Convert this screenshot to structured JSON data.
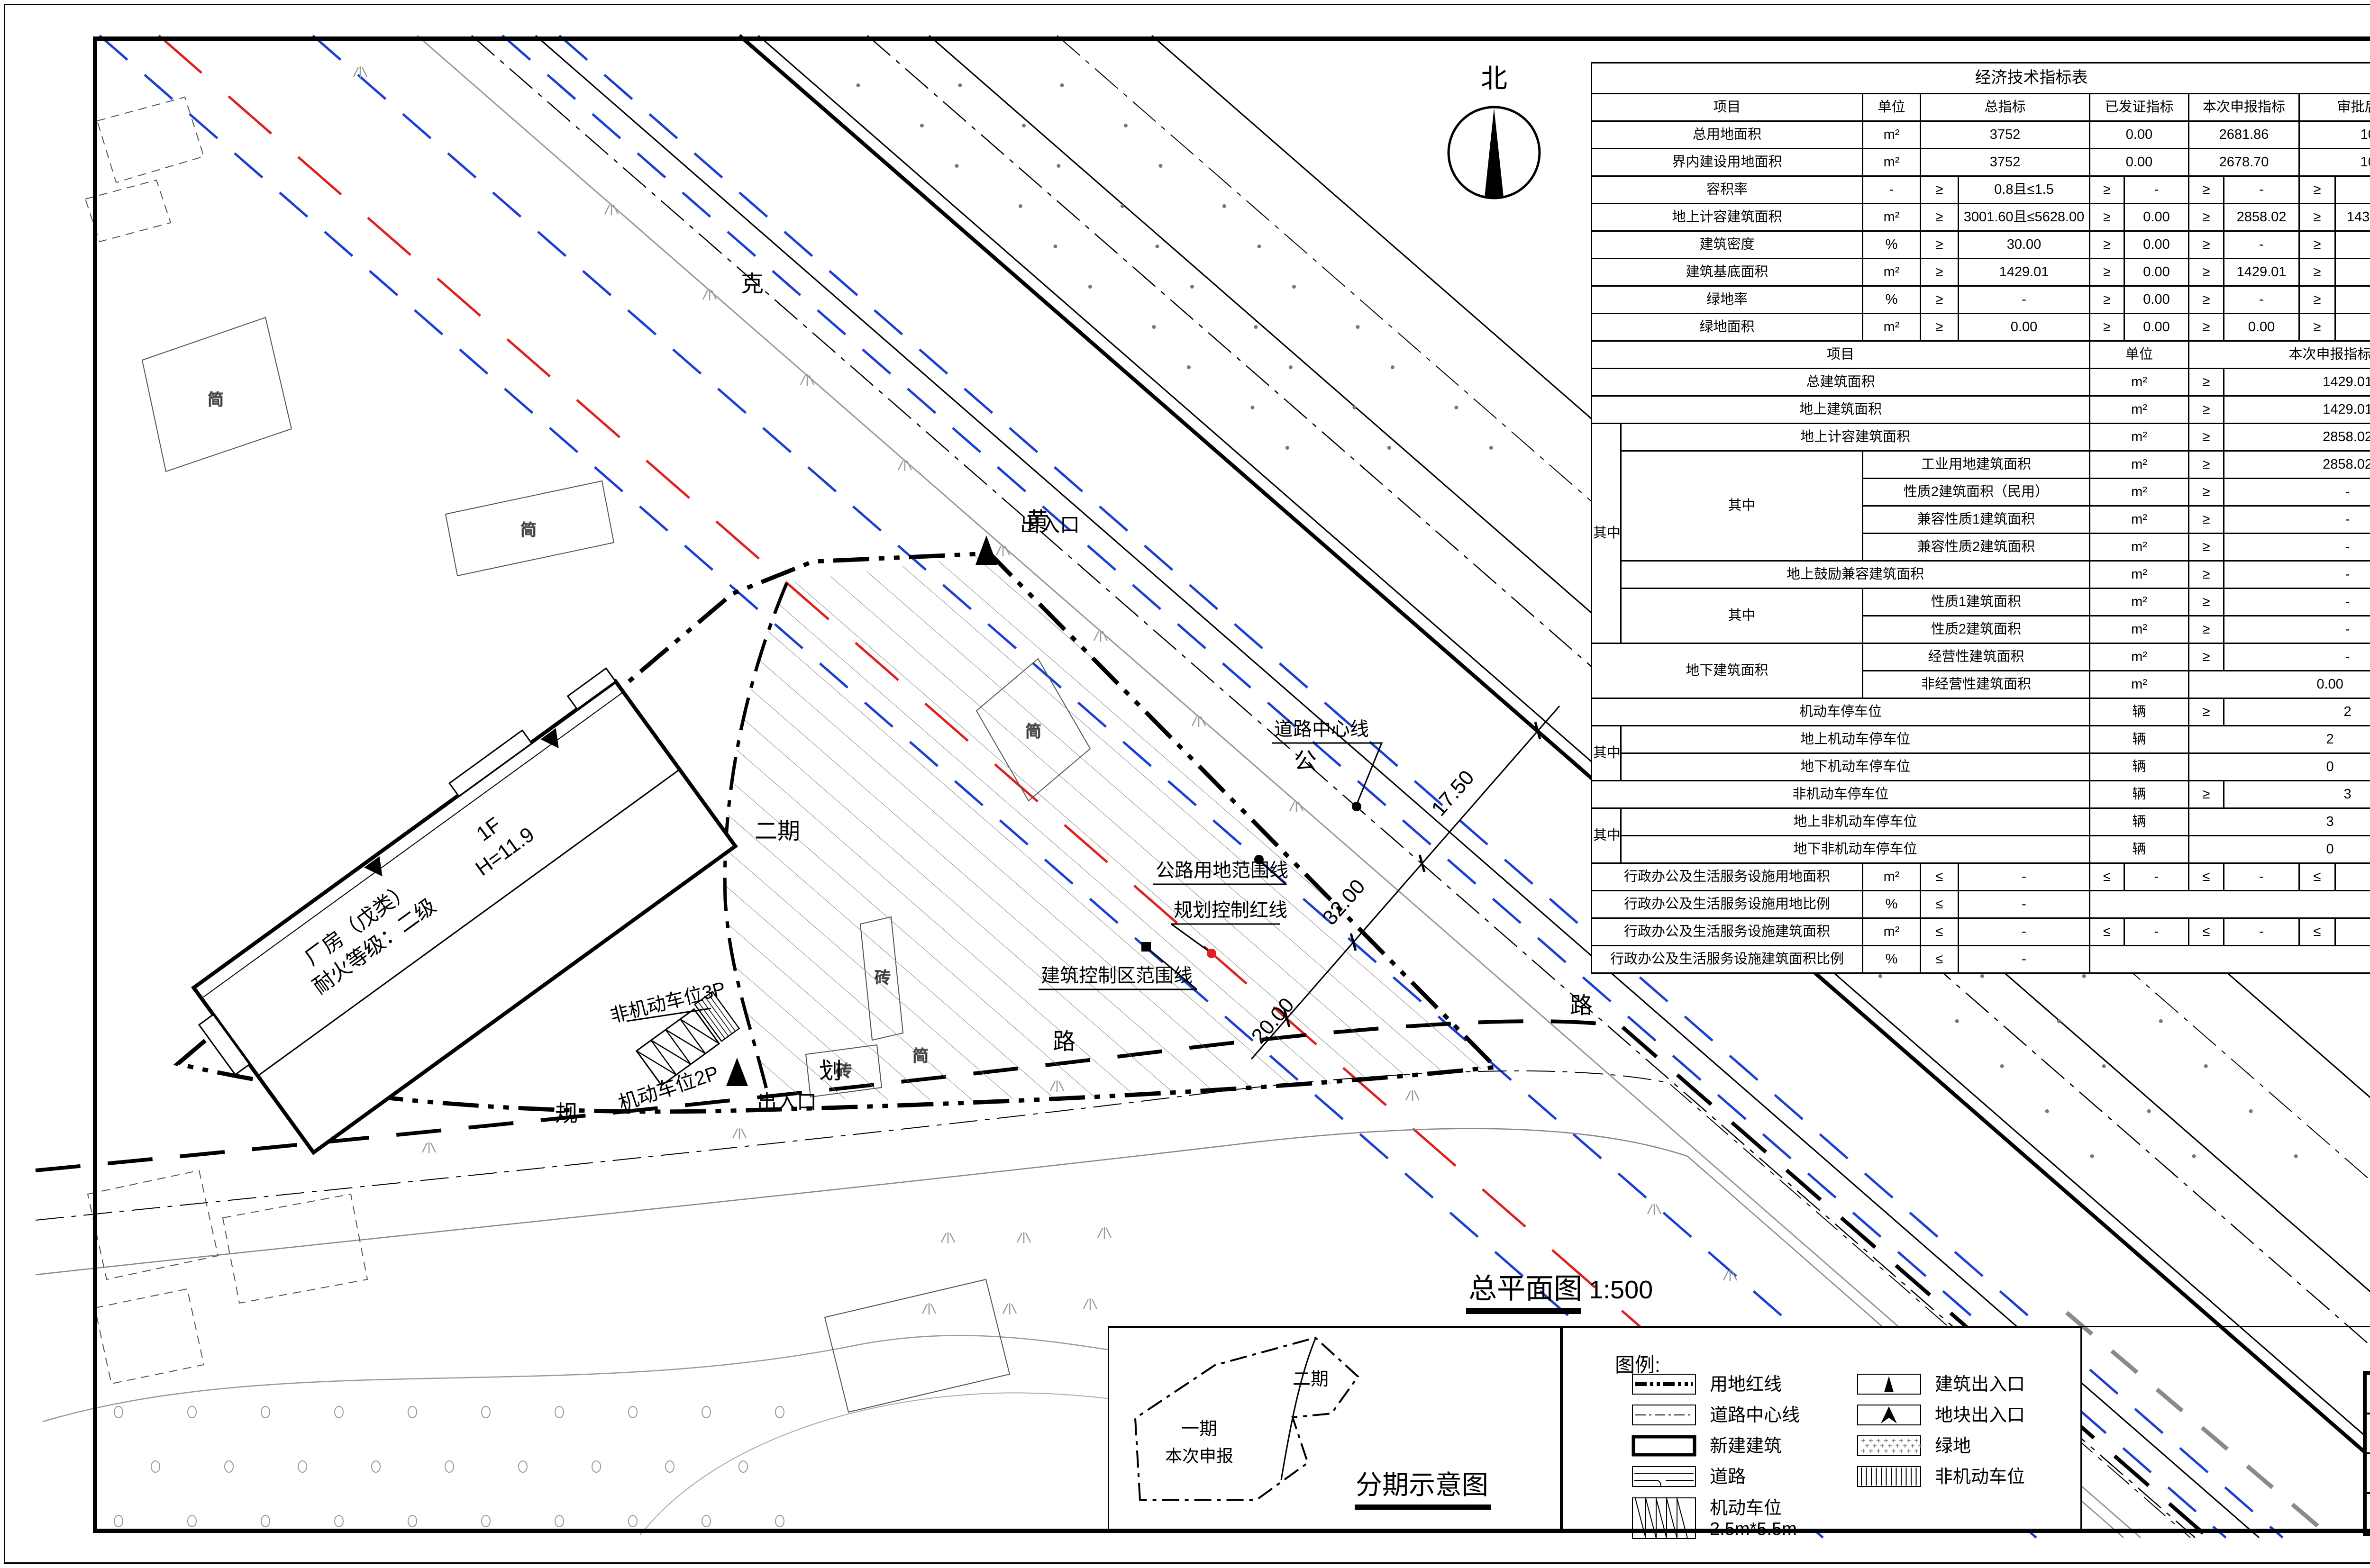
{
  "north": {
    "label": "北"
  },
  "plan_title": {
    "text": "总平面图",
    "scale": "1:500"
  },
  "plan_labels": {
    "road_name_chars": [
      "克",
      "黄",
      "公",
      "路"
    ],
    "road2_chars": [
      "规",
      "划",
      "路"
    ],
    "centerline": "道路中心线",
    "highway_range": "公路用地范围线",
    "planning_red": "规划控制红线",
    "building_control": "建筑控制区范围线",
    "entrance_top": "出入口",
    "entrance_bottom": "出入口",
    "phase2": "二期",
    "motor_parking": "机动车位2P",
    "bike_parking": "非机动车位3P",
    "bldg_line1": "厂房（戊类）",
    "bldg_line2": "耐火等级：二级",
    "bldg_line3": "1F",
    "bldg_line4": "H=11.9",
    "dim1": "32.00",
    "dim2": "17.50",
    "dim3": "20.00",
    "simple1": "简",
    "simple2": "简",
    "simple3": "简",
    "simple4": "简",
    "brick1": "砖",
    "brick2": "砖"
  },
  "legend": {
    "title": "图例:",
    "left": [
      {
        "icon": "red-line-icon",
        "label": "用地红线"
      },
      {
        "icon": "road-centerline-icon",
        "label": "道路中心线"
      },
      {
        "icon": "new-building-icon",
        "label": "新建建筑"
      },
      {
        "icon": "road-icon",
        "label": "道路"
      },
      {
        "icon": "parking-icon",
        "label": "机动车位",
        "label2": "2.5m*5.5m"
      }
    ],
    "right": [
      {
        "icon": "building-entrance-icon",
        "label": "建筑出入口"
      },
      {
        "icon": "site-entrance-icon",
        "label": "地块出入口"
      },
      {
        "icon": "green-icon",
        "label": "绿地"
      },
      {
        "icon": "bike-parking-icon",
        "label": "非机动车位"
      }
    ]
  },
  "phasing": {
    "title": "分期示意图",
    "phase1": "一期",
    "phase1_note": "本次申报",
    "phase2": "二期"
  },
  "title_panel": {
    "project_chars": [
      "年",
      "生",
      "产",
      "10",
      "万",
      "套",
      "水",
      "泥",
      "预",
      "制",
      "件",
      "项",
      "目"
    ],
    "drawing_chars": [
      "总",
      "平",
      "面",
      "图"
    ],
    "scale": "1:500"
  },
  "title_block": {
    "rows": [
      {
        "label": "建设单位",
        "value": "天津市蓟州区上仓镇梁庄子村村民委员会"
      },
      {
        "label": "电 话",
        "value": "13920283886"
      },
      {
        "label": "设计单位",
        "value": "中外建华诚工程技术集团有限公司"
      },
      {
        "label": "电 话",
        "value": "13512984037"
      }
    ]
  },
  "indicator_table": {
    "title": "经济技术指标表",
    "rows": [
      [
        {
          "t": "经济技术指标表",
          "cs": 11
        }
      ],
      [
        {
          "t": "项目",
          "cs": 2
        },
        {
          "t": "单位"
        },
        {
          "t": "总指标",
          "cs": 2
        },
        {
          "t": "已发证指标",
          "cs": 2
        },
        {
          "t": "本次申报指标",
          "cs": 2
        },
        {
          "t": "审批后剩余指标",
          "cs": 2
        }
      ],
      [
        {
          "t": "总用地面积",
          "cs": 2
        },
        {
          "t": "m²"
        },
        {
          "t": "3752",
          "cs": 2
        },
        {
          "t": "0.00",
          "cs": 2
        },
        {
          "t": "2681.86",
          "cs": 2
        },
        {
          "t": "1070.14",
          "cs": 2
        }
      ],
      [
        {
          "t": "界内建设用地面积",
          "cs": 2
        },
        {
          "t": "m²"
        },
        {
          "t": "3752",
          "cs": 2
        },
        {
          "t": "0.00",
          "cs": 2
        },
        {
          "t": "2678.70",
          "cs": 2
        },
        {
          "t": "1070.14",
          "cs": 2
        }
      ],
      [
        {
          "t": "容积率",
          "cs": 2
        },
        {
          "t": "-"
        },
        {
          "t": "≥"
        },
        {
          "t": "0.8且≤1.5"
        },
        {
          "t": "≥"
        },
        {
          "t": "-"
        },
        {
          "t": "≥"
        },
        {
          "t": "-"
        },
        {
          "t": "≥"
        },
        {
          "t": "-"
        }
      ],
      [
        {
          "t": "地上计容建筑面积",
          "cs": 2
        },
        {
          "t": "m²"
        },
        {
          "t": "≥"
        },
        {
          "t": "3001.60且≤5628.00"
        },
        {
          "t": "≥"
        },
        {
          "t": "0.00"
        },
        {
          "t": "≥"
        },
        {
          "t": "2858.02"
        },
        {
          "t": "≥"
        },
        {
          "t": "143.58且≤2769.98"
        }
      ],
      [
        {
          "t": "建筑密度",
          "cs": 2
        },
        {
          "t": "%"
        },
        {
          "t": "≥"
        },
        {
          "t": "30.00"
        },
        {
          "t": "≥"
        },
        {
          "t": "0.00"
        },
        {
          "t": "≥"
        },
        {
          "t": "-"
        },
        {
          "t": "≥"
        },
        {
          "t": "-"
        }
      ],
      [
        {
          "t": "建筑基底面积",
          "cs": 2
        },
        {
          "t": "m²"
        },
        {
          "t": "≥"
        },
        {
          "t": "1429.01"
        },
        {
          "t": "≥"
        },
        {
          "t": "0.00"
        },
        {
          "t": "≥"
        },
        {
          "t": "1429.01"
        },
        {
          "t": "≥"
        },
        {
          "t": "-"
        }
      ],
      [
        {
          "t": "绿地率",
          "cs": 2
        },
        {
          "t": "%"
        },
        {
          "t": "≥"
        },
        {
          "t": "-"
        },
        {
          "t": "≥"
        },
        {
          "t": "0.00"
        },
        {
          "t": "≥"
        },
        {
          "t": "-"
        },
        {
          "t": "≥"
        },
        {
          "t": "-"
        }
      ],
      [
        {
          "t": "绿地面积",
          "cs": 2
        },
        {
          "t": "m²"
        },
        {
          "t": "≥"
        },
        {
          "t": "0.00"
        },
        {
          "t": "≥"
        },
        {
          "t": "0.00"
        },
        {
          "t": "≥"
        },
        {
          "t": "0.00"
        },
        {
          "t": "≥"
        },
        {
          "t": "-"
        }
      ],
      [
        {
          "t": "项目",
          "cs": 5
        },
        {
          "t": "单位",
          "cs": 2
        },
        {
          "t": "本次申报指标",
          "cs": 4
        }
      ],
      [
        {
          "t": "总建筑面积",
          "cs": 5
        },
        {
          "t": "m²",
          "cs": 2
        },
        {
          "t": "≥"
        },
        {
          "t": "1429.01",
          "cs": 3
        }
      ],
      [
        {
          "t": "地上建筑面积",
          "cs": 5
        },
        {
          "t": "m²",
          "cs": 2
        },
        {
          "t": "≥"
        },
        {
          "t": "1429.01",
          "cs": 3
        }
      ],
      [
        {
          "t": "其中",
          "rs": 8
        },
        {
          "t": "地上计容建筑面积",
          "cs": 4
        },
        {
          "t": "m²",
          "cs": 2
        },
        {
          "t": "≥"
        },
        {
          "t": "2858.02",
          "cs": 3
        }
      ],
      [
        {
          "t": "其中",
          "rs": 4
        },
        {
          "t": "工业用地建筑面积",
          "cs": 3
        },
        {
          "t": "m²",
          "cs": 2
        },
        {
          "t": "≥"
        },
        {
          "t": "2858.02",
          "cs": 3
        }
      ],
      [
        {
          "t": "性质2建筑面积（民用）",
          "cs": 3
        },
        {
          "t": "m²",
          "cs": 2
        },
        {
          "t": "≥"
        },
        {
          "t": "-",
          "cs": 3
        }
      ],
      [
        {
          "t": "兼容性质1建筑面积",
          "cs": 3
        },
        {
          "t": "m²",
          "cs": 2
        },
        {
          "t": "≥"
        },
        {
          "t": "-",
          "cs": 3
        }
      ],
      [
        {
          "t": "兼容性质2建筑面积",
          "cs": 3
        },
        {
          "t": "m²",
          "cs": 2
        },
        {
          "t": "≥"
        },
        {
          "t": "-",
          "cs": 3
        }
      ],
      [
        {
          "t": "地上鼓励兼容建筑面积",
          "cs": 4
        },
        {
          "t": "m²",
          "cs": 2
        },
        {
          "t": "≥"
        },
        {
          "t": "-",
          "cs": 3
        }
      ],
      [
        {
          "t": "其中",
          "rs": 2
        },
        {
          "t": "性质1建筑面积",
          "cs": 3
        },
        {
          "t": "m²",
          "cs": 2
        },
        {
          "t": "≥"
        },
        {
          "t": "-",
          "cs": 3
        }
      ],
      [
        {
          "t": "性质2建筑面积",
          "cs": 3
        },
        {
          "t": "m²",
          "cs": 2
        },
        {
          "t": "≥"
        },
        {
          "t": "-",
          "cs": 3
        }
      ],
      [
        {
          "t": "地下建筑面积",
          "cs": 2,
          "rs": 2
        },
        {
          "t": "经营性建筑面积",
          "cs": 3
        },
        {
          "t": "m²",
          "cs": 2
        },
        {
          "t": "≥"
        },
        {
          "t": "-",
          "cs": 3
        }
      ],
      [
        {
          "t": "非经营性建筑面积",
          "cs": 3
        },
        {
          "t": "m²",
          "cs": 2
        },
        {
          "t": "0.00",
          "cs": 4
        }
      ],
      [
        {
          "t": "机动车停车位",
          "cs": 5
        },
        {
          "t": "辆",
          "cs": 2
        },
        {
          "t": "≥"
        },
        {
          "t": "2",
          "cs": 3
        }
      ],
      [
        {
          "t": "其中",
          "rs": 2
        },
        {
          "t": "地上机动车停车位",
          "cs": 4
        },
        {
          "t": "辆",
          "cs": 2
        },
        {
          "t": "2",
          "cs": 4
        }
      ],
      [
        {
          "t": "地下机动车停车位",
          "cs": 4
        },
        {
          "t": "辆",
          "cs": 2
        },
        {
          "t": "0",
          "cs": 4
        }
      ],
      [
        {
          "t": "非机动车停车位",
          "cs": 5
        },
        {
          "t": "辆",
          "cs": 2
        },
        {
          "t": "≥"
        },
        {
          "t": "3",
          "cs": 3
        }
      ],
      [
        {
          "t": "其中",
          "rs": 2
        },
        {
          "t": "地上非机动车停车位",
          "cs": 4
        },
        {
          "t": "辆",
          "cs": 2
        },
        {
          "t": "3",
          "cs": 4
        }
      ],
      [
        {
          "t": "地下非机动车停车位",
          "cs": 4
        },
        {
          "t": "辆",
          "cs": 2
        },
        {
          "t": "0",
          "cs": 4
        }
      ],
      [
        {
          "t": "行政办公及生活服务设施用地面积",
          "cs": 2
        },
        {
          "t": "m²"
        },
        {
          "t": "≤"
        },
        {
          "t": "-"
        },
        {
          "t": "≤"
        },
        {
          "t": "-"
        },
        {
          "t": "≤"
        },
        {
          "t": "-"
        },
        {
          "t": "≤"
        },
        {
          "t": "-"
        }
      ],
      [
        {
          "t": "行政办公及生活服务设施用地比例",
          "cs": 2
        },
        {
          "t": "%"
        },
        {
          "t": "≤"
        },
        {
          "t": "-"
        },
        {
          "t": "",
          "cs": 6
        }
      ],
      [
        {
          "t": "行政办公及生活服务设施建筑面积",
          "cs": 2
        },
        {
          "t": "m²"
        },
        {
          "t": "≤"
        },
        {
          "t": "-"
        },
        {
          "t": "≤"
        },
        {
          "t": "-"
        },
        {
          "t": "≤"
        },
        {
          "t": "-"
        },
        {
          "t": "≤"
        },
        {
          "t": "-"
        }
      ],
      [
        {
          "t": "行政办公及生活服务设施建筑面积比例",
          "cs": 2
        },
        {
          "t": "%"
        },
        {
          "t": "≤"
        },
        {
          "t": "-"
        },
        {
          "t": "",
          "cs": 6
        }
      ]
    ]
  }
}
